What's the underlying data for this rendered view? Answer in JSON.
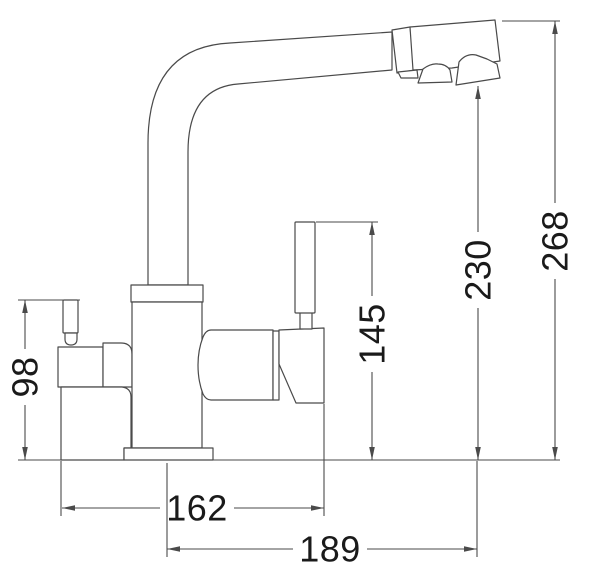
{
  "diagram": {
    "type": "technical-drawing",
    "subject": "two-handle kitchen faucet, side elevation with dimensions",
    "line_color": "#4a4a4a",
    "label_color": "#1a1a1a",
    "background": "#ffffff",
    "dimensions": {
      "overall_height": {
        "value": "268",
        "orientation": "vertical"
      },
      "spout_outlet_height": {
        "value": "230",
        "orientation": "vertical"
      },
      "side_lever_height": {
        "value": "145",
        "orientation": "vertical"
      },
      "left_valve_height": {
        "value": "98",
        "orientation": "vertical"
      },
      "spout_reach": {
        "value": "162",
        "orientation": "horizontal"
      },
      "overall_reach": {
        "value": "189",
        "orientation": "horizontal"
      }
    }
  }
}
